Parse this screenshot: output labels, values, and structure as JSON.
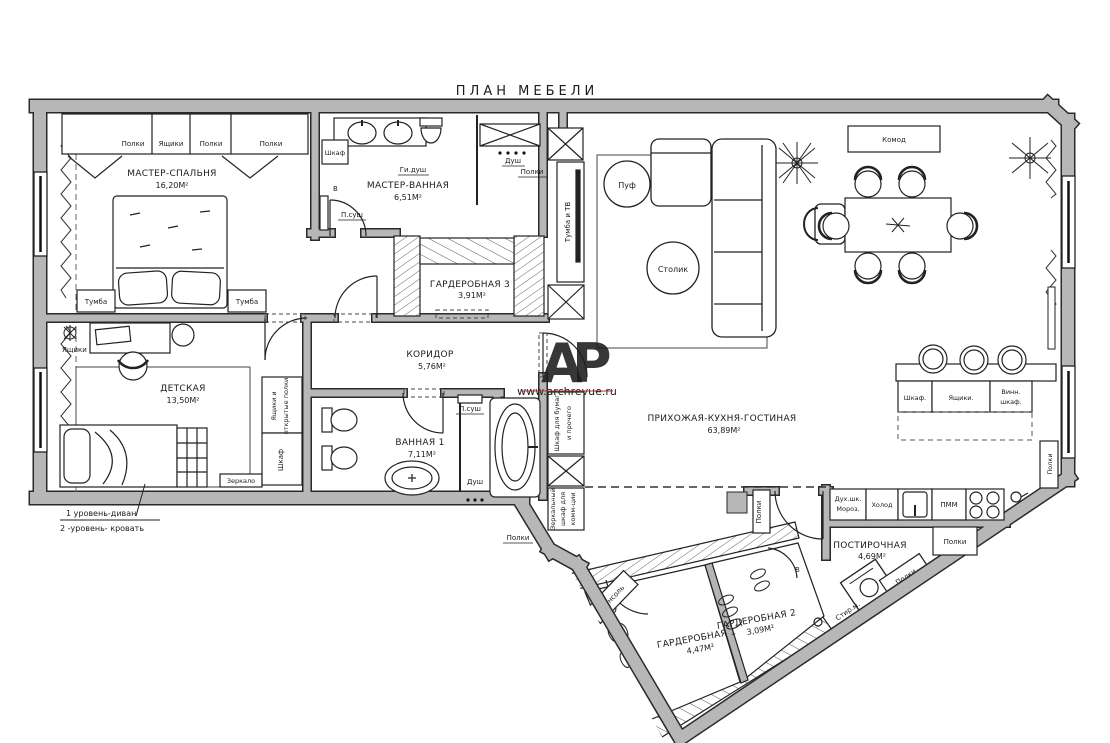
{
  "title": "ПЛАН МЕБЕЛИ",
  "rooms": [
    {
      "id": "master-bedroom",
      "name": "МАСТЕР-СПАЛЬНЯ",
      "area": "16,20М²"
    },
    {
      "id": "master-bath",
      "name": "МАСТЕР-ВАННАЯ",
      "area": "6,51М²"
    },
    {
      "id": "wardrobe-3",
      "name": "ГАРДЕРОБНАЯ 3",
      "area": "3,91М²"
    },
    {
      "id": "corridor",
      "name": "КОРИДОР",
      "area": "5,76М²"
    },
    {
      "id": "kids-room",
      "name": "ДЕТСКАЯ",
      "area": "13,50М²"
    },
    {
      "id": "bath-1",
      "name": "ВАННАЯ 1",
      "area": "7,11М²"
    },
    {
      "id": "great-room",
      "name": "ПРИХОЖАЯ-КУХНЯ-ГОСТИНАЯ",
      "area": "63,89М²"
    },
    {
      "id": "laundry",
      "name": "ПОСТИРОЧНАЯ",
      "area": "4,69М²"
    },
    {
      "id": "wardrobe-1",
      "name": "ГАРДЕРОБНАЯ 1",
      "area": "4,47М²"
    },
    {
      "id": "wardrobe-2",
      "name": "ГАРДЕРОБНАЯ 2",
      "area": "3,09М²"
    }
  ],
  "labels": {
    "polki": "Полки",
    "yashchiki": "Ящики",
    "tumba": "Тумба",
    "shkaf": "Шкаф",
    "gi_dush": "Ги.душ",
    "p_sush": "П.суш",
    "dush": "Душ",
    "tumba_tv": "Тумба и ТВ",
    "komod": "Комод",
    "puf": "Пуф",
    "stolik": "Столик",
    "zerkalo": "Зеркало",
    "yashchiki_otkr_1": "Ящики и",
    "yashchiki_otkr_2": "открытые полки",
    "shkaf_bumag_1": "Шкаф для бумаг",
    "shkaf_bumag_2": "и прочего",
    "zerk_shkaf_1": "Зеркальный",
    "zerk_shkaf_2": "шкаф для",
    "zerk_shkaf_3": "комм-ции",
    "shkaf_dot": "Шкаф.",
    "yashchiki_dot": "Ящики.",
    "vinn_1": "Винн.",
    "vinn_2": "шкаф.",
    "pmm": "ПММ",
    "holod": "Холод",
    "duh_shk": "Дух.шк.",
    "moroz": "Мороз.",
    "stir_m": "Стир.м.",
    "konsol": "Консоль",
    "v_mark": "В"
  },
  "notes": {
    "line1": "1 уровень-диван",
    "line2": "2 -уровень- кровать"
  },
  "watermark": {
    "letter_a": "А",
    "letter_p": "Р",
    "url": "www.archrevue.ru",
    "color_a": "#8a4040",
    "color_p": "#9b9b9b",
    "color_url": "#b03030"
  }
}
